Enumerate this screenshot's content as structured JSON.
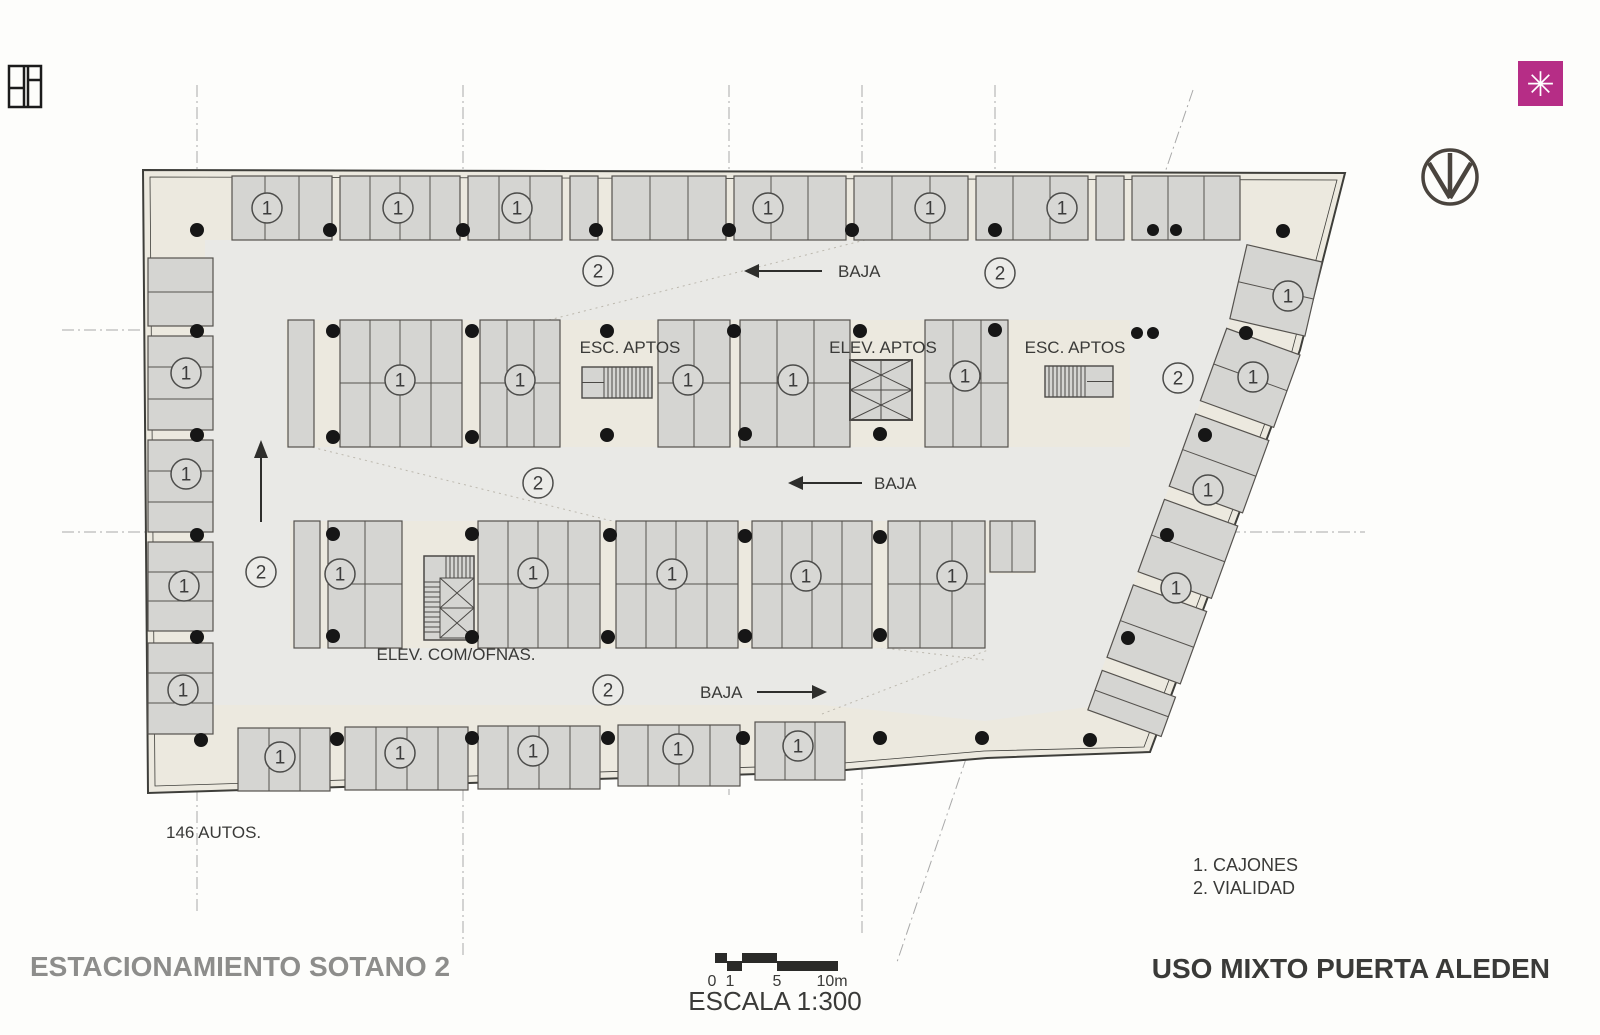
{
  "branding": {
    "logo_symbol": "✳",
    "logo_color": "#b62d86"
  },
  "plan": {
    "labels": {
      "esc_aptos_1": "ESC. APTOS",
      "elev_aptos": "ELEV. APTOS",
      "esc_aptos_2": "ESC. APTOS",
      "elev_com_ofnas": "ELEV. COM/OFNAS.",
      "baja": "BAJA",
      "autos_count": "146 AUTOS."
    },
    "stall_marker_label": "1",
    "lane_marker_label": "2",
    "stall_markers": [
      [
        267,
        208
      ],
      [
        398,
        208
      ],
      [
        517,
        208
      ],
      [
        768,
        208
      ],
      [
        930,
        208
      ],
      [
        1062,
        208
      ],
      [
        186,
        373
      ],
      [
        186,
        474
      ],
      [
        184,
        586
      ],
      [
        183,
        690
      ],
      [
        400,
        380
      ],
      [
        520,
        380
      ],
      [
        688,
        380
      ],
      [
        793,
        380
      ],
      [
        965,
        376
      ],
      [
        340,
        574
      ],
      [
        533,
        573
      ],
      [
        672,
        574
      ],
      [
        806,
        576
      ],
      [
        952,
        576
      ],
      [
        280,
        757
      ],
      [
        400,
        753
      ],
      [
        533,
        751
      ],
      [
        678,
        749
      ],
      [
        798,
        746
      ],
      [
        1288,
        296
      ],
      [
        1253,
        377
      ],
      [
        1208,
        490
      ],
      [
        1176,
        588
      ]
    ],
    "lane_markers": [
      [
        598,
        271
      ],
      [
        1000,
        273
      ],
      [
        261,
        572
      ],
      [
        538,
        483
      ],
      [
        1178,
        378
      ],
      [
        608,
        690
      ]
    ]
  },
  "legend": {
    "item1": "1. CAJONES",
    "item2": "2. VIALIDAD"
  },
  "titles": {
    "sheet": "ESTACIONAMIENTO SOTANO 2",
    "project": "USO MIXTO PUERTA ALEDEN",
    "project_color": "#d6245e"
  },
  "scale_bar": {
    "tick0": "0",
    "tick1": "1",
    "tick2": "5",
    "tick3": "10m",
    "label": "ESCALA 1:300"
  }
}
